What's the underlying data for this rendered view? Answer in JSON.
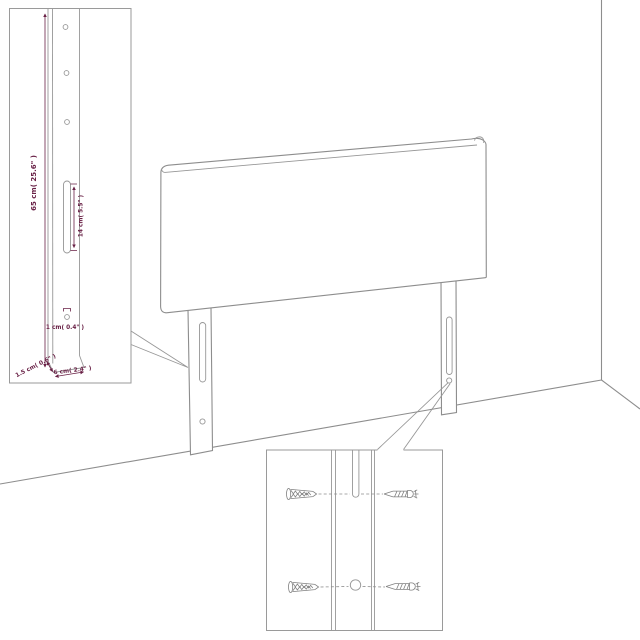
{
  "page": {
    "background": "#ffffff",
    "description": "Assembly dimension diagram of an upholstered headboard with two slotted legs leaning against a room corner, with an enlarged leg-dimension inset and a wall-mounting hardware inset"
  },
  "colors": {
    "outline": "#8d8d8d",
    "dimension_text": "#692146",
    "inset_border": "#9a9a9a"
  },
  "leg_dimension_inset": {
    "height_label": "65 cm( 25.6\" )",
    "slot_label": "14 cm( 5.5\" )",
    "hole_label": "1 cm( 0.4\" )",
    "thickness_label": "1.5 cm( 0.6\" )",
    "width_label": "6 cm( 2.4\" )"
  },
  "hardware_inset": {
    "items": [
      {
        "icon": "wall-plug-icon"
      },
      {
        "icon": "screw-icon"
      },
      {
        "icon": "wall-plug-icon"
      },
      {
        "icon": "screw-icon"
      }
    ]
  }
}
